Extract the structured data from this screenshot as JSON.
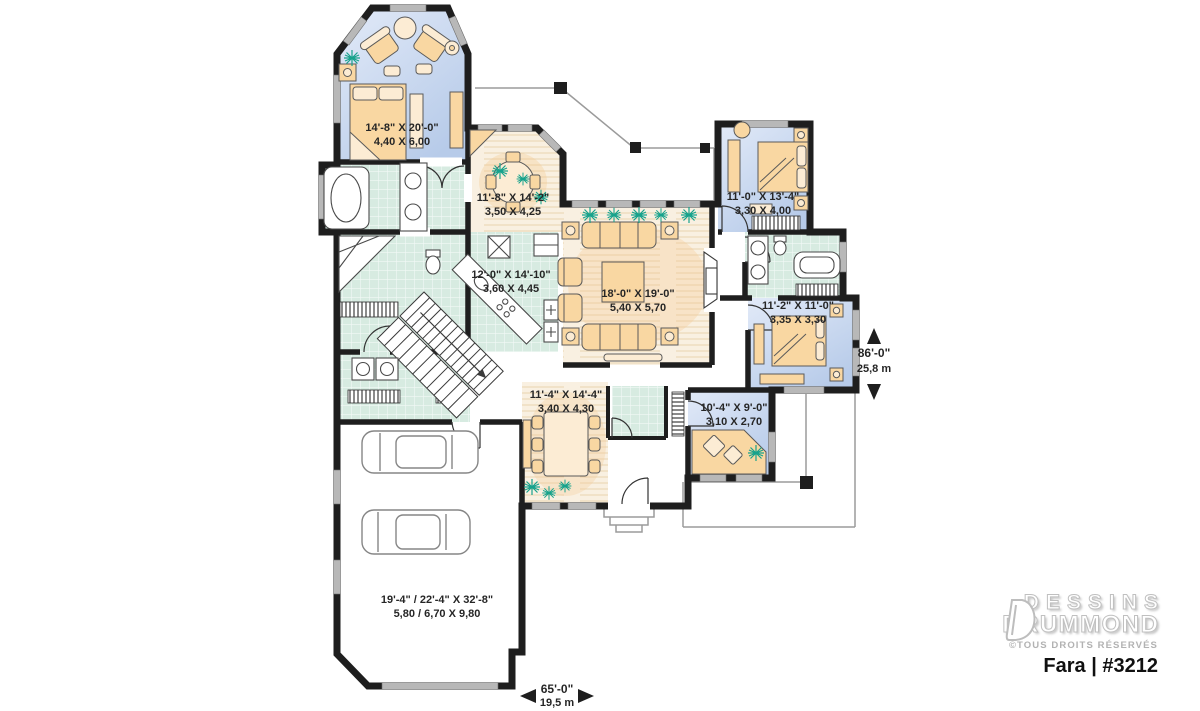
{
  "plan": {
    "rooms": [
      {
        "id": "master-bedroom",
        "imperial": "14'-8\" X 20'-0\"",
        "metric": "4,40 X 6,00"
      },
      {
        "id": "breakfast-nook",
        "imperial": "11'-8\" X 14'-2\"",
        "metric": "3,50 X 4,25"
      },
      {
        "id": "bedroom-2",
        "imperial": "11'-0\" X 13'-4\"",
        "metric": "3,30 X 4,00"
      },
      {
        "id": "kitchen",
        "imperial": "12'-0\" X 14'-10\"",
        "metric": "3,60 X 4,45"
      },
      {
        "id": "living-room",
        "imperial": "18'-0\" X 19'-0\"",
        "metric": "5,40 X 5,70"
      },
      {
        "id": "bedroom-3",
        "imperial": "11'-2\" X 11'-0\"",
        "metric": "3,35 X 3,30"
      },
      {
        "id": "dining-room",
        "imperial": "11'-4\" X 14'-4\"",
        "metric": "3,40 X 4,30"
      },
      {
        "id": "office",
        "imperial": "10'-4\" X 9'-0\"",
        "metric": "3,10 X 2,70"
      },
      {
        "id": "garage",
        "imperial": "19'-4\" / 22'-4\" X 32'-8\"",
        "metric": "5,80 / 6,70 X 9,80"
      }
    ],
    "overall": {
      "depth_imperial": "86'-0\"",
      "depth_metric": "25,8 m",
      "width_imperial": "65'-0\"",
      "width_metric": "19,5 m"
    }
  },
  "branding": {
    "brand_line1": "DESSINS",
    "brand_line2": "DRUMMOND",
    "rights": "©TOUS DROITS RÉSERVÉS",
    "model": "Fara | #3212"
  },
  "colors": {
    "walls": "#1e1e1e",
    "bedroom_fill": "#c4d4ee",
    "tile_fill": "#d7ebe1",
    "wood_floor": "#f7ecdb",
    "furniture": "#f9d7a2",
    "plants": "#17a28c"
  }
}
